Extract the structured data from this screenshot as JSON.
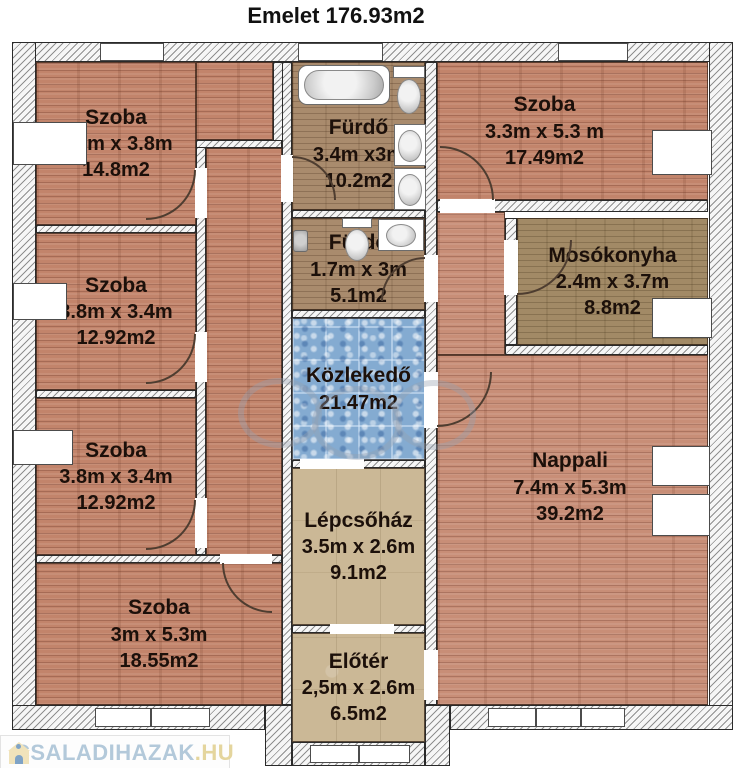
{
  "title": "Emelet 176.93m2",
  "rooms": {
    "szoba_tl": {
      "name": "Szoba",
      "dims": "3.3m x 3.8m",
      "area": "14.8m2"
    },
    "furdo_top": {
      "name": "Fürdő",
      "dims": "3.4m x3m",
      "area": "10.2m2"
    },
    "szoba_tr": {
      "name": "Szoba",
      "dims": "3.3m x 5.3 m",
      "area": "17.49m2"
    },
    "szoba_ml": {
      "name": "Szoba",
      "dims": "3.8m x 3.4m",
      "area": "12.92m2"
    },
    "furdo_small": {
      "name": "Fürdő",
      "dims": "1.7m x 3m",
      "area": "5.1m2"
    },
    "mosokonyha": {
      "name": "Mosókonyha",
      "dims": "2.4m x 3.7m",
      "area": "8.8m2"
    },
    "szoba_ll": {
      "name": "Szoba",
      "dims": "3.8m x 3.4m",
      "area": "12.92m2"
    },
    "kozlekedo": {
      "name": "Közlekedő",
      "area": "21.47m2"
    },
    "nappali": {
      "name": "Nappali",
      "dims": "7.4m x 5.3m",
      "area": "39.2m2"
    },
    "lepcsohaz": {
      "name": "Lépcsőház",
      "dims": "3.5m x 2.6m",
      "area": "9.1m2"
    },
    "szoba_b": {
      "name": "Szoba",
      "dims": "3m x 5.3m",
      "area": "18.55m2"
    },
    "eloter": {
      "name": "Előtér",
      "dims": "2,5m x 2.6m",
      "area": "6.5m2"
    }
  },
  "logo": {
    "text": "CSALADIHAZAK",
    "suffix": ".HU"
  },
  "colors": {
    "brick_floor": "#c2846b",
    "bath_floor": "#a98b6d",
    "laundry_floor": "#a28a66",
    "stair_floor": "#cbb896",
    "hall_tile": "#84abd1",
    "logo_blue": "#b3c9da",
    "logo_gold": "#e4d59d"
  }
}
